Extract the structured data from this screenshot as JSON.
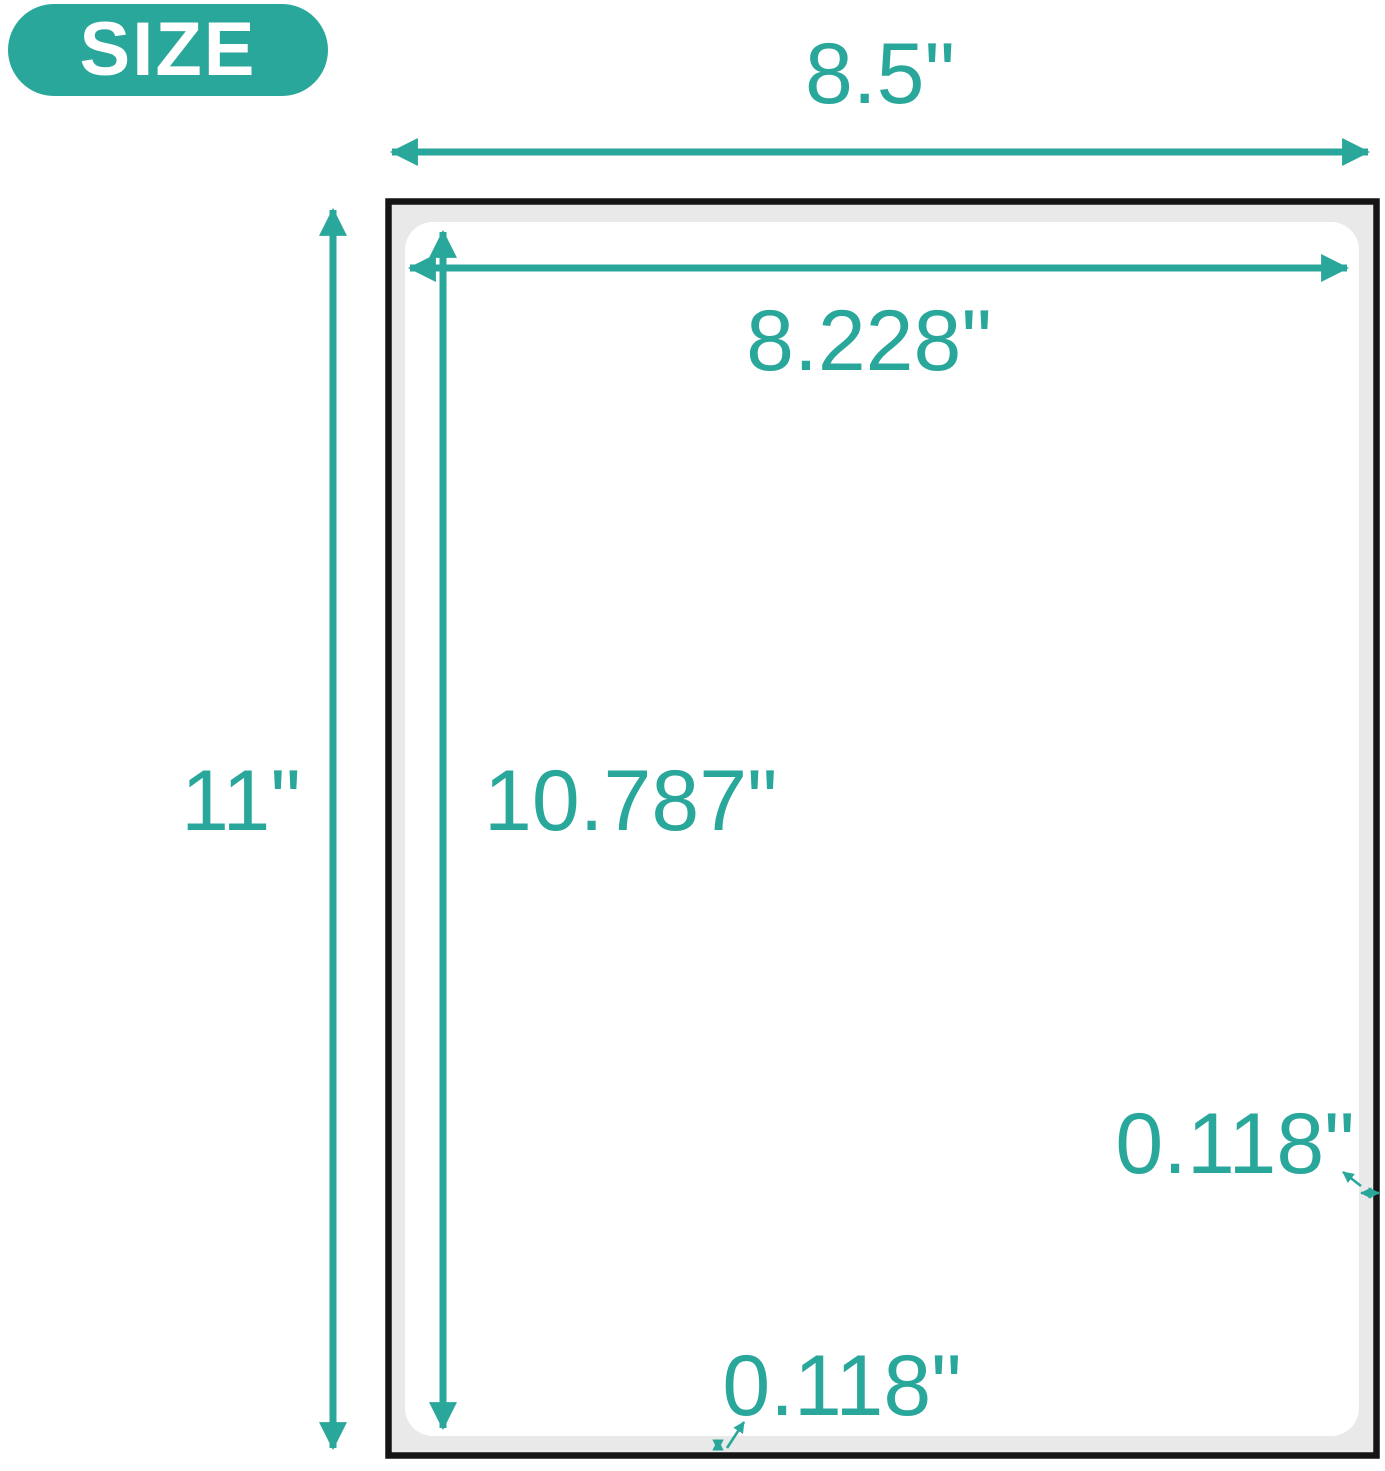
{
  "badge": {
    "label": "SIZE"
  },
  "colors": {
    "accent": "#2aa79b",
    "sheet_border": "#151515",
    "backing_fill": "#e9e9e9",
    "label_fill": "#ffffff",
    "background": "#ffffff",
    "badge_text": "#ffffff"
  },
  "dimensions": {
    "sheet_width": "8.5\"",
    "sheet_height": "11\"",
    "label_width": "8.228\"",
    "label_height": "10.787\"",
    "bottom_margin": "0.118\"",
    "right_margin": "0.118\""
  }
}
